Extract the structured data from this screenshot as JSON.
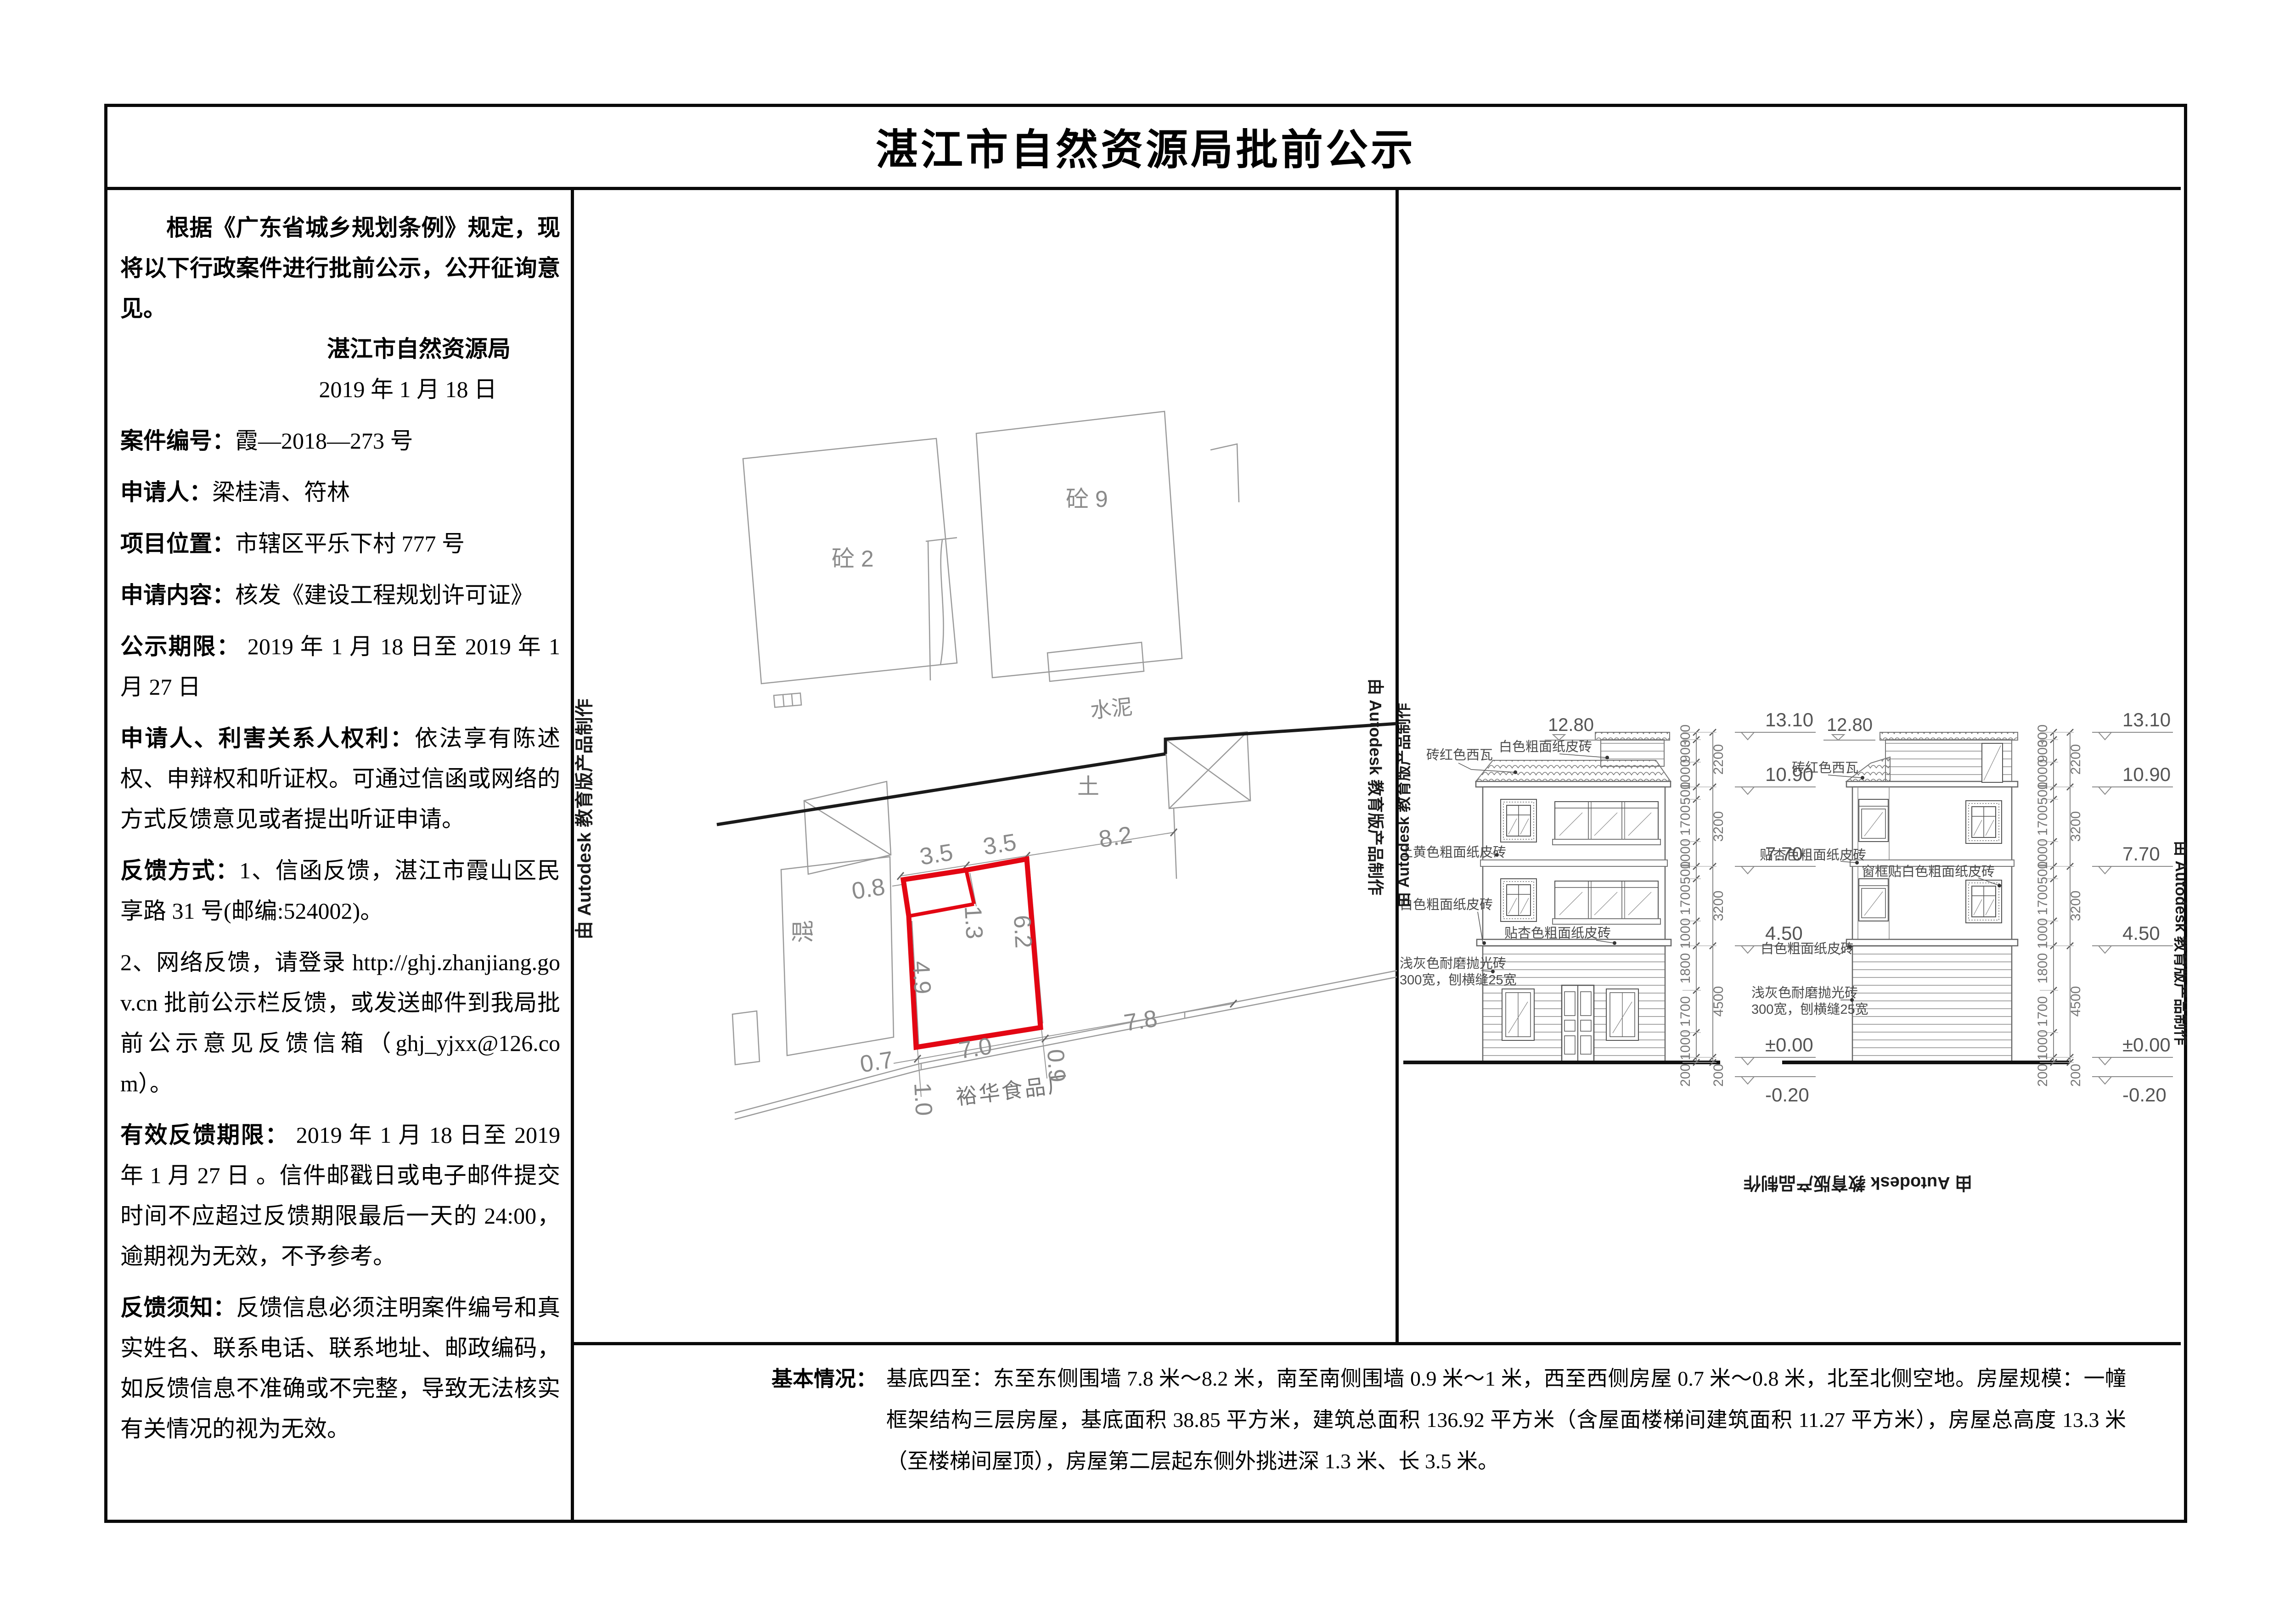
{
  "title": "湛江市自然资源局批前公示",
  "notice": {
    "intro": "根据《广东省城乡规划条例》规定，现将以下行政案件进行批前公示，公开征询意见。",
    "agency": "湛江市自然资源局",
    "date": "2019 年 1 月 18 日",
    "fields": [
      {
        "label": "案件编号：",
        "text": "霞—2018—273 号"
      },
      {
        "label": "申请人：",
        "text": "梁桂清、符林"
      },
      {
        "label": "项目位置：",
        "text": "市辖区平乐下村 777 号"
      },
      {
        "label": "申请内容：",
        "text": "核发《建设工程规划许可证》"
      },
      {
        "label": "公示期限：",
        "text": " 2019 年 1 月 18 日至 2019 年 1 月 27 日"
      },
      {
        "label": "申请人、利害关系人权利：",
        "text": "依法享有陈述权、申辩权和听证权。可通过信函或网络的方式反馈意见或者提出听证申请。"
      },
      {
        "label": "反馈方式：",
        "text": "1、信函反馈，湛江市霞山区民享路 31 号(邮编:524002)。"
      },
      {
        "label": "",
        "text": "2、网络反馈，请登录 http://ghj.zhanjiang.gov.cn 批前公示栏反馈，或发送邮件到我局批前公示意见反馈信箱（ghj_yjxx@126.com）。"
      },
      {
        "label": "有效反馈期限：",
        "text": " 2019 年 1 月 18 日至 2019 年 1 月 27 日 。信件邮戳日或电子邮件提交时间不应超过反馈期限最后一天的 24:00，逾期视为无效，不予参考。"
      },
      {
        "label": "反馈须知：",
        "text": "反馈信息必须注明案件编号和真实姓名、联系电话、联系地址、邮政编码，如反馈信息不准确或不完整，导致无法核实有关情况的视为无效。"
      }
    ]
  },
  "basic_info": {
    "label": "基本情况：",
    "text": "基底四至：东至东侧围墙 7.8 米～8.2 米，南至南侧围墙 0.9 米～1 米，西至西侧房屋 0.7 米～0.8 米，北至北侧空地。房屋规模：一幢框架结构三层房屋，基底面积 38.85 平方米，建筑总面积 136.92 平方米（含屋面楼梯间建筑面积 11.27 平方米），房屋总高度 13.3 米（至楼梯间屋顶），房屋第二层起东侧外挑进深 1.3 米、长 3.5 米。"
  },
  "watermark": "由 Autodesk 教育版产品制作",
  "site_plan": {
    "building_concrete2": "砼 2",
    "building_concrete9": "砼 9",
    "building_mixed": "混",
    "road_label": "水泥",
    "soil_label": "土",
    "factory_label": "裕华食品厂",
    "dims": {
      "top1": "3.5",
      "top2": "3.5",
      "east": "8.2",
      "west": "0.8",
      "notch": "1.3",
      "right": "6.2",
      "left": "4.9",
      "bottom": "7.0",
      "sw": "0.7",
      "se": "7.8",
      "south1": "1.0",
      "south2": "0.9"
    }
  },
  "elevations": {
    "mid_level": "12.80",
    "levels": [
      "13.10",
      "10.90",
      "7.70",
      "4.50",
      "±0.00",
      "-0.20"
    ],
    "chain_inner": [
      "300",
      "900",
      "1000",
      "500",
      "1700",
      "1000",
      "500",
      "1700",
      "1000",
      "1800",
      "1700",
      "1000",
      "200"
    ],
    "chain_outer": [
      "2200",
      "3200",
      "3200",
      "4500",
      "200"
    ],
    "labels": {
      "tile": "砖红色西瓦",
      "white": "白色粗面纸皮砖",
      "yellow": "土黄色粗面纸皮砖",
      "apricot": "贴杏色粗面纸皮砖",
      "frame_white": "窗框贴白色粗面纸皮砖",
      "gray1": "浅灰色耐磨抛光砖",
      "gray2": "300宽，刨横缝25宽"
    }
  }
}
